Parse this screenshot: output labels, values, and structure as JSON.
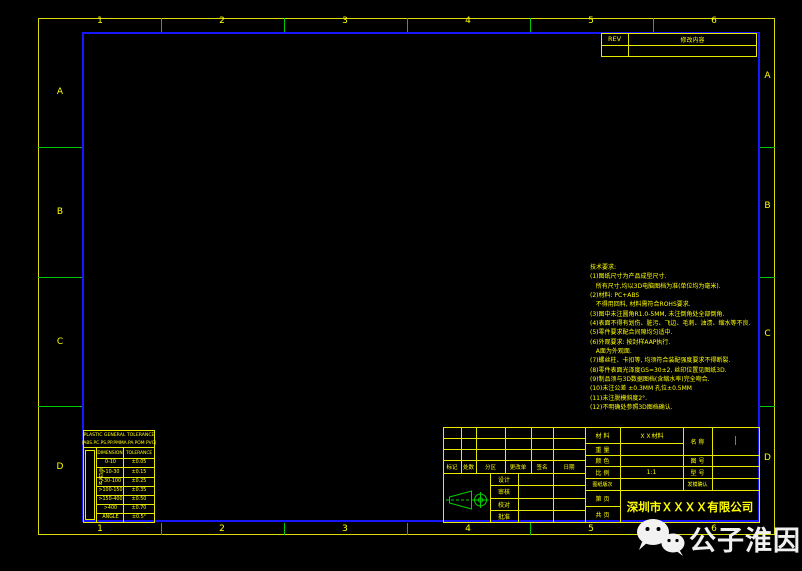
{
  "colors": {
    "line_yellow": "#e8e800",
    "text_yellow": "#ffff00",
    "frame_blue": "#1616ff",
    "tick_green": "#00c800",
    "value_orange": "#ff8c00",
    "watermark_white": "#efefef"
  },
  "zones": {
    "top": [
      "1",
      "2",
      "3",
      "4",
      "5",
      "6"
    ],
    "bottom": [
      "1",
      "2",
      "3",
      "4",
      "5",
      "6"
    ],
    "left": [
      "A",
      "B",
      "C",
      "D"
    ],
    "right": [
      "A",
      "B",
      "C",
      "D"
    ]
  },
  "rev_table": {
    "rev_label": "REV",
    "change_header": "修改内容"
  },
  "tech_requirements": {
    "lines": [
      "技术要求:",
      "(1)图纸尺寸为产品成型尺寸.",
      "   所有尺寸,均以3D电脑图档为准(单位均为毫米).",
      "(2)材料: PC+ABS",
      "   不得用回料, 材料需符合ROHS要求.",
      "(3)图中未注圆角R1.0-5MM, 未注倒角处全部倒角.",
      "(4)表面不得有划伤、脏污、飞边、毛刺、油渍、缩水等不良.",
      "(5)零件要求配合间隙均匀适中.",
      "(6)外观要求: 按封样AAP执行.",
      "   A面为外观面.",
      "(7)螺丝柱、卡扣等, 均须符合装配强度要求不得断裂.",
      "(8)零件表面光泽度GS=30±2, 丝印位置见图纸3D.",
      "(9)制品须与3D数据图档(含缩水率)完全吻合.",
      "(10)未注公差 ±0.3MM 孔位±0.5MM",
      "(11)未注脱模斜度2°.",
      "(12)不明确处参照3D图档确认."
    ]
  },
  "tolerance_table": {
    "title_line1": "PLASTIC GENERAL TOLERANCE",
    "title_line2": "(ABS.PC.PS.PP.PMMA.PA.POM PVC)",
    "side_label": "单位MM",
    "col_dimension": "DIMENSION",
    "col_tolerance": "TOLERANCE",
    "rows": [
      {
        "dimension": "0-10",
        "tolerance": "±0.05"
      },
      {
        "dimension": ">10-30",
        "tolerance": "±0.15"
      },
      {
        "dimension": ">30-100",
        "tolerance": "±0.25"
      },
      {
        "dimension": ">100-150",
        "tolerance": "±0.35"
      },
      {
        "dimension": ">150-400",
        "tolerance": "±0.50"
      },
      {
        "dimension": ">400",
        "tolerance": "±0.70"
      },
      {
        "dimension": "ANGLE",
        "tolerance": "±0.5°"
      }
    ]
  },
  "title_block": {
    "revision_cols": [
      "标记",
      "处数",
      "分区",
      "更改单",
      "签名",
      "日期"
    ],
    "approval_rows": [
      "设计",
      "审核",
      "校对",
      "批准"
    ],
    "fields": {
      "material_label": "材 料",
      "material_value": "ＸＸ材料",
      "weight_label": "重 量",
      "color_label": "颜 色",
      "scale_label": "比 例",
      "scale_value": "1:1",
      "revision_label": "图纸版次",
      "page_label": "第 页",
      "pages_label": "共 页",
      "name_label": "名 称",
      "name_value": "|",
      "drawing_no_label": "图 号",
      "model_label": "型 号",
      "mold_confirm_label": "发模确认",
      "company": "深圳市ＸＸＸＸ有限公司"
    },
    "projection_symbol": "first-angle-projection"
  },
  "watermark": {
    "text": "公子淮因",
    "icon": "wechat-icon"
  }
}
